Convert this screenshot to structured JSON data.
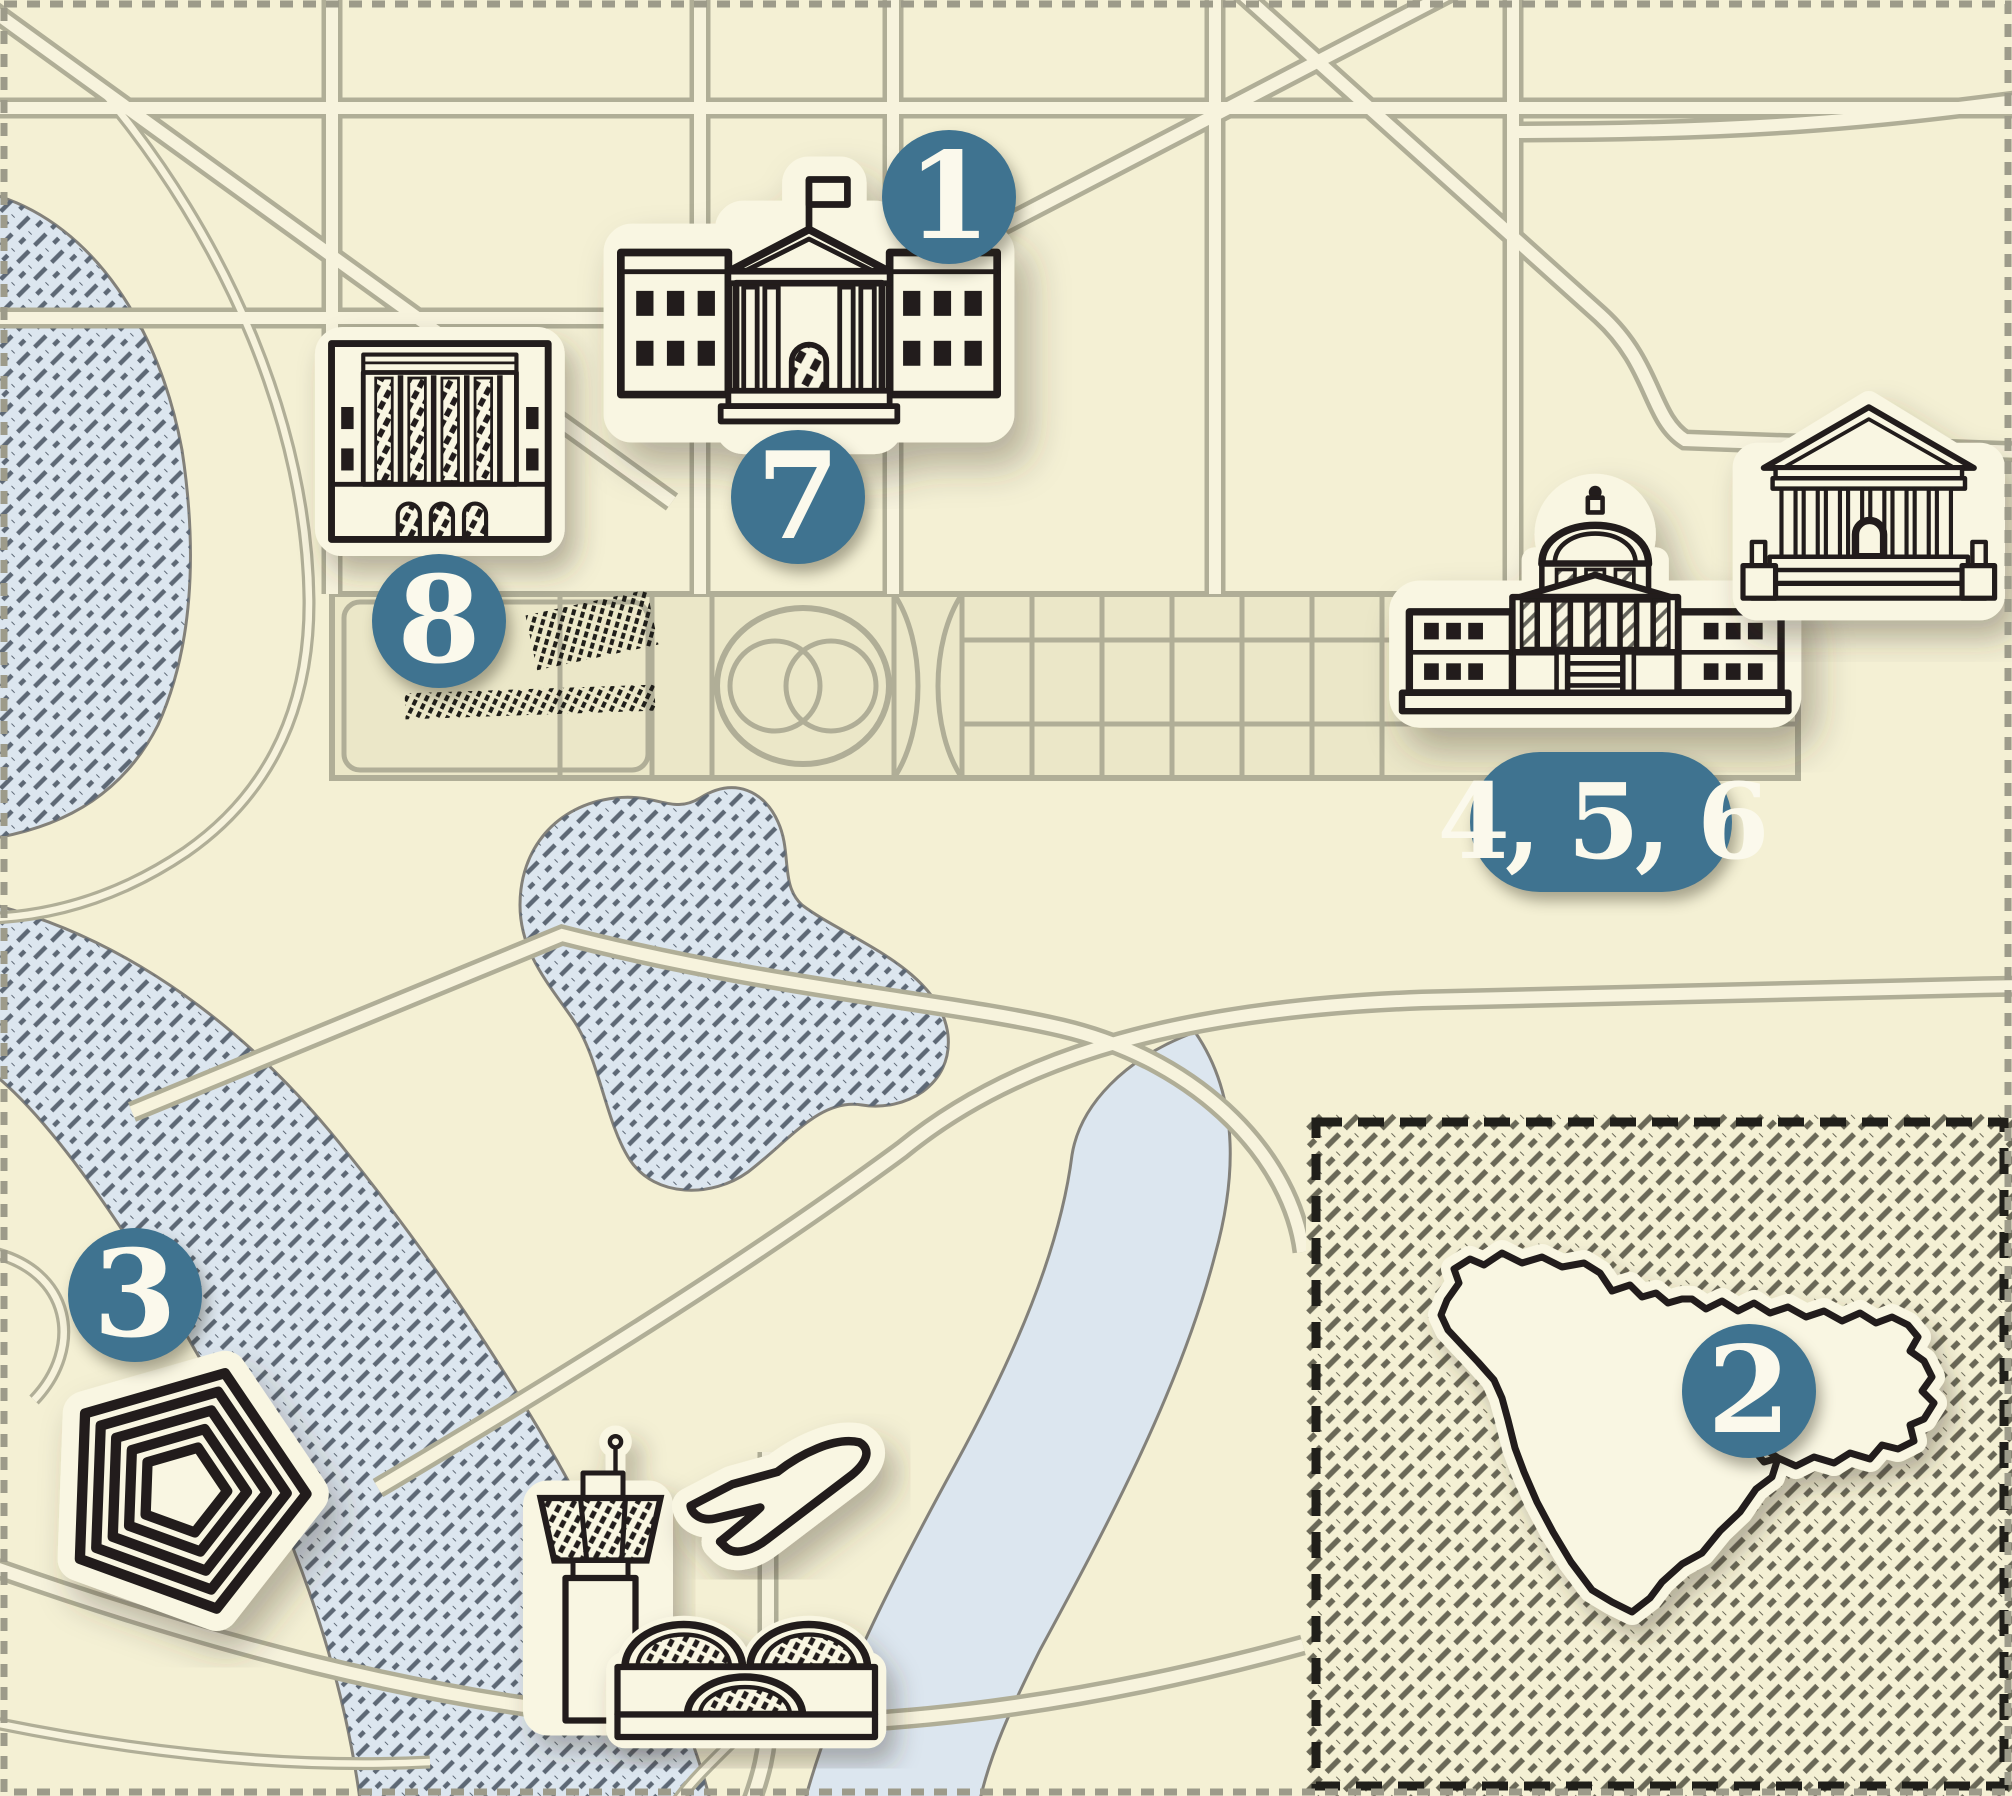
{
  "markers": {
    "m1": {
      "label": "1"
    },
    "m2": {
      "label": "2"
    },
    "m3": {
      "label": "3"
    },
    "m456": {
      "label": "4, 5, 6"
    },
    "m7": {
      "label": "7"
    },
    "m8": {
      "label": "8"
    }
  },
  "icons": {
    "white_house": "white-house-icon",
    "federal_building": "federal-building-icon",
    "capitol": "us-capitol-icon",
    "supreme_court": "supreme-court-icon",
    "pentagon": "pentagon-icon",
    "control_tower": "airport-control-tower-icon",
    "terminal": "airport-terminal-icon",
    "airplane": "airplane-icon",
    "middle_east": "middle-east-map-icon"
  },
  "colors": {
    "bg": "#f4f0d4",
    "road-casing": "#b0ae97",
    "road-fill": "#f7f3dd",
    "mall-fill": "#ebe7c8",
    "water-fill": "#dce6ef",
    "water-edge": "#83817a",
    "water-ink": "#5d6875",
    "ink": "#201f1a",
    "sticker": "#f9f6e2",
    "marker-fill": "#3f7390",
    "marker-text": "#fbf9ec",
    "inset-ink": "#6a6857",
    "border-dash": "#9d9b8a",
    "col-hatch": "#63625a"
  }
}
